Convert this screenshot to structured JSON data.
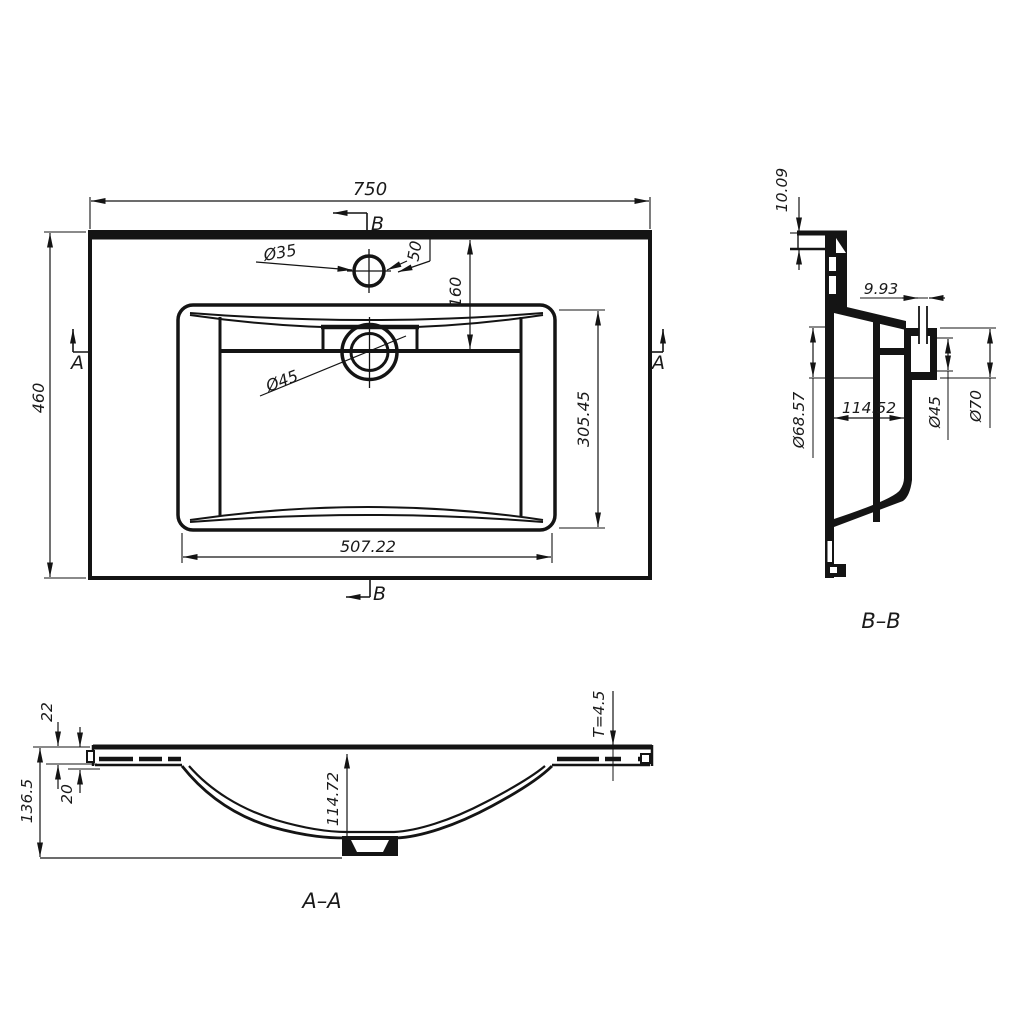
{
  "top_view": {
    "dim_width": "750",
    "dim_depth": "460",
    "dim_basin_width": "507.22",
    "dim_basin_depth": "305.45",
    "dim_faucet_dia": "Ø35",
    "dim_faucet_offset": "50",
    "dim_drain_offset": "160",
    "dim_drain_dia": "Ø45",
    "marker_a": "A",
    "marker_b": "B"
  },
  "section_bb": {
    "label": "B–B",
    "dim_lip_height": "10.09",
    "dim_sleeve_width": "9.93",
    "dim_outlet_dia": "Ø68.57",
    "dim_basin_depth": "114.52",
    "dim_hole_dia": "Ø45",
    "dim_boss_dia": "Ø70"
  },
  "section_aa": {
    "label": "A–A",
    "dim_edge_height": "22",
    "dim_recess_depth": "20",
    "dim_total_height": "136.5",
    "dim_bowl_depth": "114.72",
    "dim_thickness": "T=4.5"
  },
  "colors": {
    "line": "#141414",
    "background": "#ffffff"
  }
}
